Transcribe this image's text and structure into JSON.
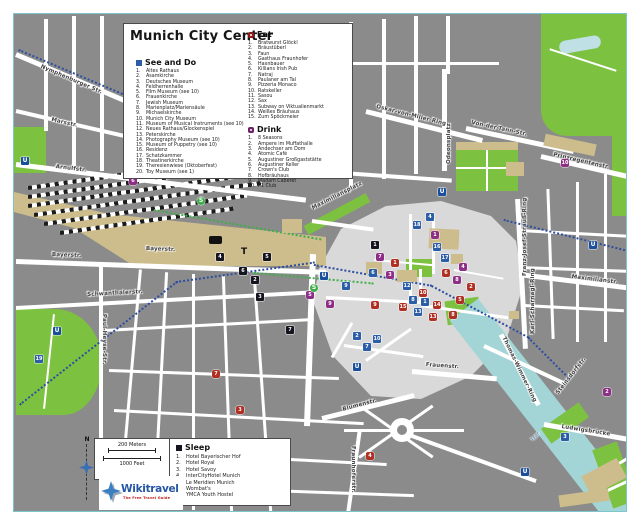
{
  "title": "Munich City Center",
  "legend": {
    "see_do": {
      "label": "See and Do",
      "items": [
        "Altes Rathaus",
        "Asamkirche",
        "Deutsches Museum",
        "Feldherrenhalle",
        "Film Museum (see 10)",
        "Frauenkirche",
        "Jewish Museum",
        "Marienplatz/Mariensäule",
        "Michaelskirche",
        "Munich City Museum",
        "Museum of Musical Instruments (see 10)",
        "Neues Rathaus/Glockenspiel",
        "Peterskirche",
        "Photography Museum (see 10)",
        "Museum of Puppetry (see 10)",
        "Residenz",
        "Schatzkammer",
        "Theatinerkirche",
        "Theresienwiese (Oktoberfest)",
        "Toy Museum (see 1)"
      ]
    },
    "eat": {
      "label": "Eat",
      "items": [
        "Bratwurst Glöckl",
        "Bräustüberl",
        "Faun",
        "Gasthaus Fraunhofer",
        "Haxnbauer",
        "Killians Irish Pub",
        "Natraj",
        "Paulaner am Tal",
        "Pizzeria Monaco",
        "Ratskeller",
        "Sasou",
        "Sax",
        "Subway on Viktualienmarkt",
        "Weißes Bräuhaus",
        "Zum Spöckmeier"
      ]
    },
    "drink": {
      "label": "Drink",
      "items": [
        "8 Seasons",
        "Ampere im Muffathalle",
        "Andechser am Dom",
        "Atomic Café",
        "Augustiner Großgaststätte",
        "Augustiner Keller",
        "Crown's Club",
        "Hofbräuhaus",
        "Madam Caberet",
        "P1 Club"
      ]
    },
    "sleep": {
      "label": "Sleep",
      "items": [
        "Hotel Bayerischer Hof",
        "Hotel Royal",
        "Hotel Savoy",
        "InterCityHotel Munich",
        "Le Meridien Munich",
        "Wombat's",
        "YMCA Youth Hostel"
      ]
    }
  },
  "scale": {
    "meters": "200 Meters",
    "feet": "1000 Feet",
    "north_label": "N"
  },
  "logo": {
    "name": "Wikitravel",
    "tagline": "The Free Travel Guide"
  },
  "streets": [
    {
      "name": "Nymphenburger Str."
    },
    {
      "name": "Marsstr."
    },
    {
      "name": "Arnulfstr."
    },
    {
      "name": "Bayerstr."
    },
    {
      "name": "Bayerstr."
    },
    {
      "name": "Schwanthalerstr."
    },
    {
      "name": "Paul-Heyse-Str."
    },
    {
      "name": "Oskar-von-Miller-Ring"
    },
    {
      "name": "Von-der-Tann-Str."
    },
    {
      "name": "Prinzregentenstr."
    },
    {
      "name": "Franz-Josef-Strauß-Ring"
    },
    {
      "name": "Karl-Scharnagl-Ring"
    },
    {
      "name": "Maximiliansplatz"
    },
    {
      "name": "Maximilianstr."
    },
    {
      "name": "Thomas-Wimmer-Ring"
    },
    {
      "name": "Steinsdorfstr."
    },
    {
      "name": "Ludwigsbrücke"
    },
    {
      "name": "Isar"
    },
    {
      "name": "Frauenstr."
    },
    {
      "name": "Blumenstr."
    },
    {
      "name": "Fraunhoferstr."
    },
    {
      "name": "Odeonsplatz"
    }
  ],
  "map_markers": {
    "see_do": [
      "19",
      "6",
      "9",
      "12",
      "8",
      "1",
      "13",
      "2",
      "10",
      "7",
      "16",
      "18",
      "4",
      "3",
      "17"
    ],
    "eat": [
      "1",
      "10",
      "13",
      "8",
      "15",
      "9",
      "2",
      "5",
      "6",
      "14",
      "4",
      "3",
      "7"
    ],
    "drink": [
      "8",
      "3",
      "4",
      "9",
      "5",
      "6",
      "7",
      "10",
      "1",
      "2"
    ],
    "sleep": [
      "1",
      "2",
      "3",
      "4",
      "5",
      "6",
      "7"
    ],
    "transit": {
      "u": "U",
      "s": "S",
      "t": "T"
    }
  },
  "colors": {
    "see_do": "#2b5ea7",
    "eat": "#b03024",
    "drink": "#8e2e86",
    "sleep": "#15151f",
    "park": "#7dc140",
    "water": "#a3d4d6",
    "logo_blue": "#2456a4",
    "logo_red": "#c01818"
  }
}
